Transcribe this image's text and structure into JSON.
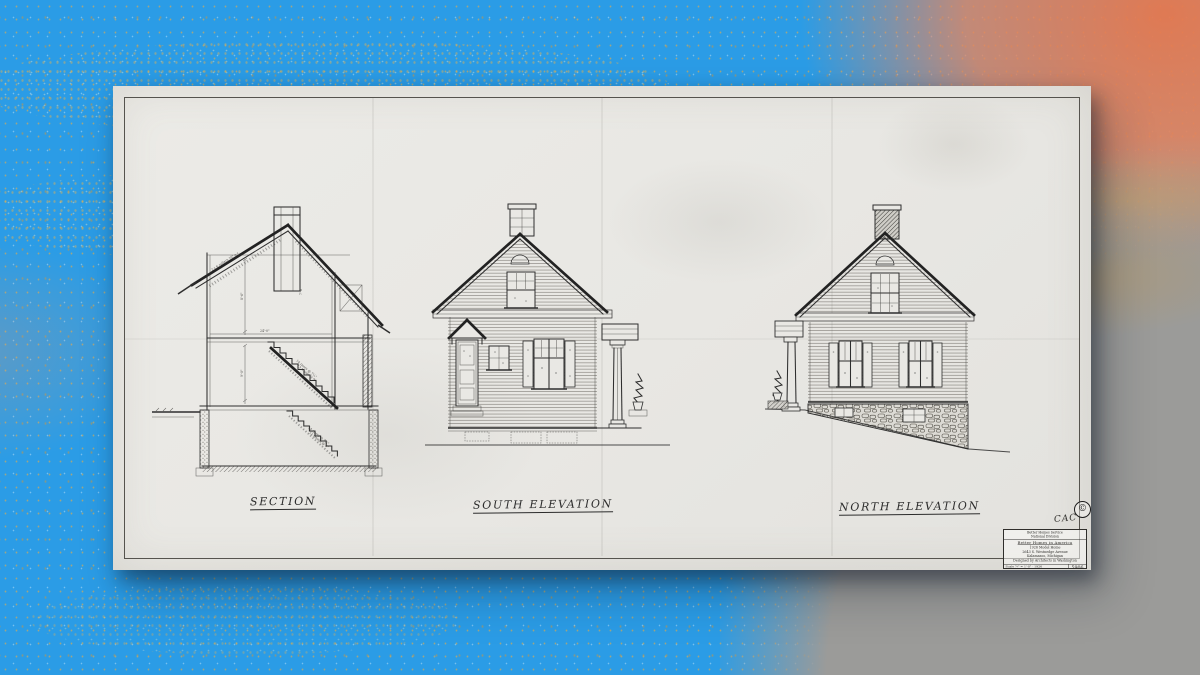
{
  "sheet": {
    "labels": {
      "section": "Section",
      "south": "South Elevation",
      "north": "North Elevation"
    },
    "section_annotations": {
      "roof_note": "2 x 6 rafters 16\" o.c.",
      "stair_upper_1": "14 risers @ 7½\"",
      "stair_upper_2": "13 treads @ 9\"",
      "stair_lower_1": "14 risers @ 7¾\"",
      "stair_lower_2": "12 treads @ 9\"",
      "dim_width": "24'-0\"",
      "dim_first": "9'-0\"",
      "dim_second": "8'-6\"",
      "dim_attic": "7'-6\""
    },
    "title_block": {
      "header_line1": "Better Homes Service",
      "header_line2": "National Division",
      "line1": "Better Homes in America",
      "line2": "1926 Model Home",
      "line3": "2643 S. Westnedge Avenue",
      "line4": "Kalamazoo, Michigan",
      "line5": "Designed by Architects in Washington",
      "scale_line": "Scale ¼\" = 1'-0\"  ·  1926",
      "number": "5906",
      "initials": "CAC",
      "stamp": "©"
    }
  },
  "colors": {
    "background_blue": "#2b9ce6",
    "splatter_orange": "#e8825a",
    "corner_gray": "#9b9b99",
    "speckle_gold": "#c9a24f",
    "paper": "#e8e7e3",
    "ink": "#2e2e2e"
  }
}
